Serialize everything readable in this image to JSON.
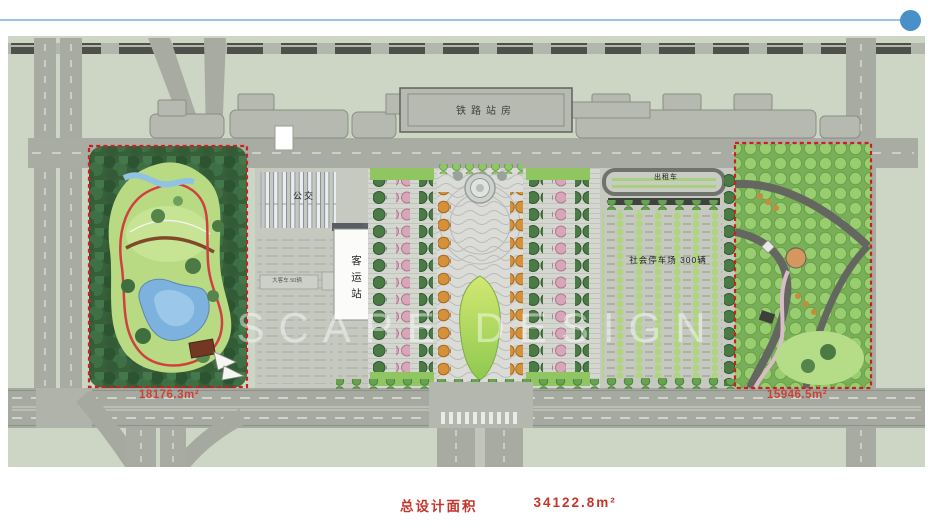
{
  "header": {
    "accent_color": "#4a90c8",
    "line_color": "#9cc0e2"
  },
  "caption": {
    "label": "总设计面积",
    "value": "34122.8m²"
  },
  "plan": {
    "labels": {
      "station": "铁路站房",
      "bus": "公交",
      "terminal": "客运站",
      "terminal_floor": "2F",
      "coach": "大客车 50辆",
      "taxi": "出租车",
      "parking": "社会停车场 300辆",
      "west_area": "18176.3m²",
      "east_area": "15946.5m²"
    },
    "watermark": "SCAPE DESIGN",
    "colors": {
      "map_bg": "#cdd6c5",
      "road": "#a7aba2",
      "building_gray": "#b6bab1",
      "terminal_white": "#fbfbfa",
      "lawn_green": "#b8da83",
      "plaza_lawn": "#a9d254",
      "lake_blue": "#7cb2dd",
      "orchard_green": "#98cd70",
      "boundary_red": "#cc2020",
      "area_text_red": "#cb4335",
      "caption_red": "#c5352b"
    }
  }
}
